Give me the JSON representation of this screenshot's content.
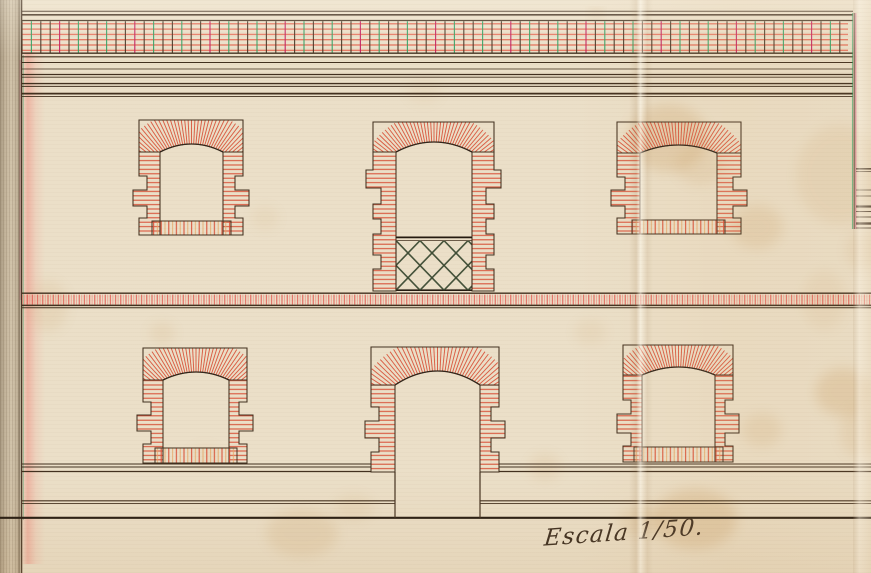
{
  "annotation": {
    "text": "Escala 1/50."
  },
  "palette": {
    "paper": "#ebdfc8",
    "ink": "#42301f",
    "ink_strong": "#241a10",
    "brick_red": "#d94f36",
    "brick_red_bright": "#e4604a",
    "brick_pink": "#f09a8e",
    "brick_orange": "#e8a463",
    "accent_green": "#2f9e60",
    "accent_magenta": "#c2185b",
    "lattice": "#3b4a33",
    "stain": "#c08a45"
  },
  "drawing": {
    "width": 871,
    "height": 573,
    "border_left": {
      "lines": [
        {
          "x": 21.5,
          "color": "ink",
          "w": 1.6,
          "y0": 0,
          "y1": 573,
          "o": 0.95
        },
        {
          "x": 23.3,
          "color": "accent_green",
          "w": 0.8,
          "y0": 55,
          "y1": 520,
          "o": 0.5
        },
        {
          "x": 20.1,
          "color": "accent_magenta",
          "w": 0.7,
          "y0": 60,
          "y1": 300,
          "o": 0.35
        }
      ]
    },
    "cornice": {
      "x0": 22,
      "x1": 853,
      "lines": [
        {
          "y": 11.3,
          "w": 1.0
        },
        {
          "y": 14.8,
          "w": 1.7
        },
        {
          "y": 20.5,
          "w": 1.2
        },
        {
          "y": 53.2,
          "w": 1.4
        },
        {
          "y": 56.8,
          "w": 1.1
        },
        {
          "y": 62.5,
          "w": 0.9
        },
        {
          "y": 69.0,
          "w": 0.7
        },
        {
          "y": 74.5,
          "w": 1.3
        },
        {
          "y": 77.2,
          "w": 0.9
        },
        {
          "y": 83.6,
          "w": 1.4
        },
        {
          "y": 86.4,
          "w": 1.0
        },
        {
          "y": 93.6,
          "w": 1.7
        },
        {
          "y": 96.6,
          "w": 0.9
        }
      ],
      "frieze": {
        "x0": 22,
        "x1": 848,
        "y0": 21.2,
        "y1": 52.6,
        "divider_step": 9.4,
        "divider_colors": [
          "ink",
          "accent_green",
          "ink",
          "ink",
          "accent_magenta",
          "ink",
          "accent_green",
          "ink"
        ]
      }
    },
    "string_course": {
      "x0": 22,
      "x1": 871,
      "top_line": {
        "y": 293.2,
        "w": 1.3
      },
      "hatch": {
        "y0": 294.6,
        "y1": 304.6
      },
      "bottom_lines": [
        {
          "y": 305.4,
          "w": 1.5
        },
        {
          "y": 307.8,
          "w": 1.0
        }
      ]
    },
    "ground_lines": [
      {
        "y": 464.0,
        "w": 1.1,
        "spans": [
          [
            22,
            371
          ],
          [
            499,
            871
          ]
        ]
      },
      {
        "y": 467.0,
        "w": 0.9,
        "spans": [
          [
            22,
            371
          ],
          [
            499,
            871
          ]
        ]
      },
      {
        "y": 471.5,
        "w": 1.2,
        "spans": [
          [
            22,
            371
          ],
          [
            499,
            871
          ]
        ]
      },
      {
        "y": 500.8,
        "w": 1.2,
        "spans": [
          [
            22,
            395
          ],
          [
            480,
            871
          ]
        ]
      },
      {
        "y": 503.6,
        "w": 0.9,
        "spans": [
          [
            22,
            395
          ],
          [
            480,
            871
          ]
        ]
      },
      {
        "y": 517.8,
        "w": 2.2,
        "spans": [
          [
            0,
            871
          ]
        ],
        "strong": true
      }
    ],
    "right_margin": {
      "vlines": [
        {
          "x": 852.4,
          "color": "accent_green",
          "w": 0.9,
          "o": 0.7
        },
        {
          "x": 854.2,
          "color": "ink",
          "w": 1.1,
          "o": 0.9
        },
        {
          "x": 855.8,
          "color": "accent_magenta",
          "w": 0.9,
          "o": 0.7
        }
      ],
      "vy": [
        13,
        229
      ],
      "x0": 856,
      "x1": 871,
      "hlines": [
        {
          "y": 168.8,
          "w": 1.6
        },
        {
          "y": 171.5,
          "w": 0.8
        },
        {
          "y": 190.0,
          "w": 0.8
        },
        {
          "y": 196.0,
          "w": 0.8
        },
        {
          "y": 206.5,
          "w": 2.2
        },
        {
          "y": 211.5,
          "w": 1.0
        },
        {
          "y": 217.0,
          "w": 1.0
        },
        {
          "y": 223.5,
          "w": 2.4
        },
        {
          "y": 228.0,
          "w": 1.0
        }
      ]
    },
    "openings": [
      {
        "id": "window-top-left",
        "kind": "window",
        "outerL": 139,
        "outerR": 243,
        "top": 120,
        "spring": 152,
        "openL": 160,
        "openR": 223,
        "rise": 8,
        "jamb_bottom": 235,
        "segs": [
          [
            24,
            0
          ],
          [
            14,
            8
          ],
          [
            16,
            -6
          ],
          [
            12,
            8
          ],
          [
            17,
            0
          ]
        ],
        "sill": {
          "y0": 221,
          "y1": 235,
          "ext": 8
        }
      },
      {
        "id": "balcony-top-center",
        "kind": "balcony",
        "outerL": 373,
        "outerR": 494,
        "top": 122,
        "spring": 152,
        "openL": 396,
        "openR": 472,
        "rise": 10,
        "jamb_bottom": 291,
        "segs": [
          [
            18,
            0
          ],
          [
            18,
            -7
          ],
          [
            16,
            8
          ],
          [
            15,
            0
          ],
          [
            15,
            8
          ],
          [
            21,
            0
          ],
          [
            14,
            8
          ],
          [
            22,
            0
          ]
        ],
        "lattice": {
          "x0": 396,
          "x1": 472,
          "rail_top": 237.4,
          "rail_top2": 240.6,
          "rail_bottom": 290.2,
          "spacing": 24,
          "run": 48
        }
      },
      {
        "id": "window-top-right",
        "kind": "window",
        "outerL": 617,
        "outerR": 741,
        "top": 122,
        "spring": 153,
        "openL": 640,
        "openR": 717,
        "rise": 8,
        "jamb_bottom": 234,
        "segs": [
          [
            24,
            0
          ],
          [
            13,
            8
          ],
          [
            16,
            -6
          ],
          [
            12,
            8
          ],
          [
            16,
            0
          ]
        ],
        "sill": {
          "y0": 220,
          "y1": 234,
          "ext": 8
        }
      },
      {
        "id": "window-bottom-left",
        "kind": "window",
        "outerL": 143,
        "outerR": 247,
        "top": 348,
        "spring": 380,
        "openL": 163,
        "openR": 229,
        "rise": 8,
        "jamb_bottom": 463,
        "segs": [
          [
            22,
            0
          ],
          [
            13,
            8
          ],
          [
            16,
            -6
          ],
          [
            13,
            8
          ],
          [
            19,
            0
          ]
        ],
        "sill": {
          "y0": 448,
          "y1": 463,
          "ext": 8
        }
      },
      {
        "id": "door-bottom-center",
        "kind": "door",
        "outerL": 371,
        "outerR": 499,
        "top": 347,
        "spring": 385,
        "openL": 395,
        "openR": 480,
        "rise": 14,
        "jamb_bottom": 472,
        "segs": [
          [
            22,
            0
          ],
          [
            14,
            8
          ],
          [
            17,
            -6
          ],
          [
            14,
            8
          ],
          [
            20,
            0
          ]
        ],
        "open_bottom": 517.8
      },
      {
        "id": "window-bottom-right",
        "kind": "window",
        "outerL": 623,
        "outerR": 733,
        "top": 345,
        "spring": 375,
        "openL": 642,
        "openR": 715,
        "rise": 8,
        "jamb_bottom": 462,
        "segs": [
          [
            25,
            0
          ],
          [
            14,
            8
          ],
          [
            19,
            -6
          ],
          [
            13,
            8
          ],
          [
            16,
            0
          ]
        ],
        "sill": {
          "y0": 447,
          "y1": 462,
          "ext": 8
        }
      }
    ],
    "stains": [
      [
        668,
        138,
        40,
        34,
        0.2
      ],
      [
        700,
        165,
        24,
        20,
        0.12
      ],
      [
        757,
        227,
        26,
        22,
        0.15
      ],
      [
        843,
        392,
        28,
        24,
        0.2
      ],
      [
        860,
        432,
        20,
        26,
        0.12
      ],
      [
        762,
        430,
        20,
        17,
        0.13
      ],
      [
        695,
        519,
        42,
        30,
        0.22
      ],
      [
        641,
        521,
        22,
        16,
        0.14
      ],
      [
        545,
        467,
        16,
        13,
        0.11
      ],
      [
        302,
        533,
        36,
        24,
        0.14
      ],
      [
        354,
        508,
        20,
        14,
        0.09
      ],
      [
        162,
        333,
        13,
        11,
        0.1
      ],
      [
        48,
        306,
        20,
        26,
        0.1
      ],
      [
        265,
        218,
        14,
        12,
        0.07
      ],
      [
        590,
        332,
        16,
        13,
        0.08
      ],
      [
        840,
        175,
        44,
        50,
        0.1
      ],
      [
        862,
        250,
        16,
        20,
        0.1
      ],
      [
        824,
        300,
        22,
        30,
        0.08
      ],
      [
        424,
        92,
        18,
        12,
        0.06
      ],
      [
        205,
        455,
        16,
        10,
        0.07
      ],
      [
        596,
        13,
        5,
        3,
        0.45
      ]
    ]
  }
}
